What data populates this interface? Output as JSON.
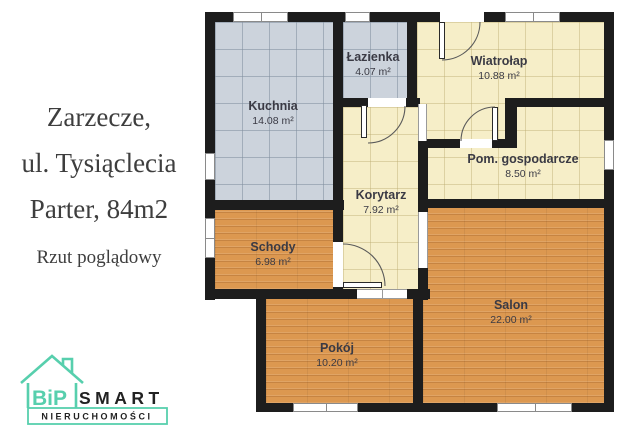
{
  "info_panel": {
    "location": "Zarzecze,",
    "street": "ul. Tysiąclecia",
    "floor_size": "Parter, 84m2",
    "caption": "Rzut poglądowy"
  },
  "logo": {
    "prefix": "BiP",
    "name": "SMART",
    "subtitle": "NIERUCHOMOŚCI",
    "accent_color": "#57cfad"
  },
  "plan": {
    "rooms": [
      {
        "id": "kuchnia",
        "name": "Kuchnia",
        "area": "14.08 m²",
        "floor": "tile-blue"
      },
      {
        "id": "lazienka",
        "name": "Łazienka",
        "area": "4.07 m²",
        "floor": "tile-blue"
      },
      {
        "id": "wiatrolap",
        "name": "Wiatrołap",
        "area": "10.88 m²",
        "floor": "tile-cream"
      },
      {
        "id": "pom-gospodarcze",
        "name": "Pom. gospodarcze",
        "area": "8.50 m²",
        "floor": "tile-cream"
      },
      {
        "id": "korytarz",
        "name": "Korytarz",
        "area": "7.92 m²",
        "floor": "tile-cream"
      },
      {
        "id": "schody",
        "name": "Schody",
        "area": "6.98 m²",
        "floor": "wood"
      },
      {
        "id": "pokoj",
        "name": "Pokój",
        "area": "10.20 m²",
        "floor": "wood"
      },
      {
        "id": "salon",
        "name": "Salon",
        "area": "22.00 m²",
        "floor": "wood"
      }
    ],
    "colors": {
      "wall": "#1d1d1d",
      "tile_blue": "#ccd3dc",
      "tile_cream": "#f6eec8",
      "wood": "#dc9850",
      "accent_teal": "#57cfad"
    }
  }
}
